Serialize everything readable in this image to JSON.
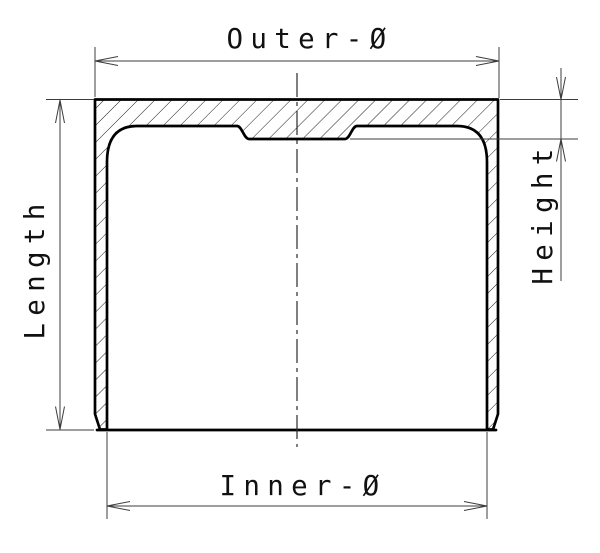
{
  "labels": {
    "outer_diameter": "Outer-Ø",
    "length": "Length",
    "height": "Height",
    "inner_diameter": "Inner-Ø"
  },
  "colors": {
    "background": "#ffffff",
    "outline": "#000000",
    "dimension_lines": "#3d3d3d",
    "hatch_lines": "#1c1c1c",
    "text": "#111111"
  }
}
